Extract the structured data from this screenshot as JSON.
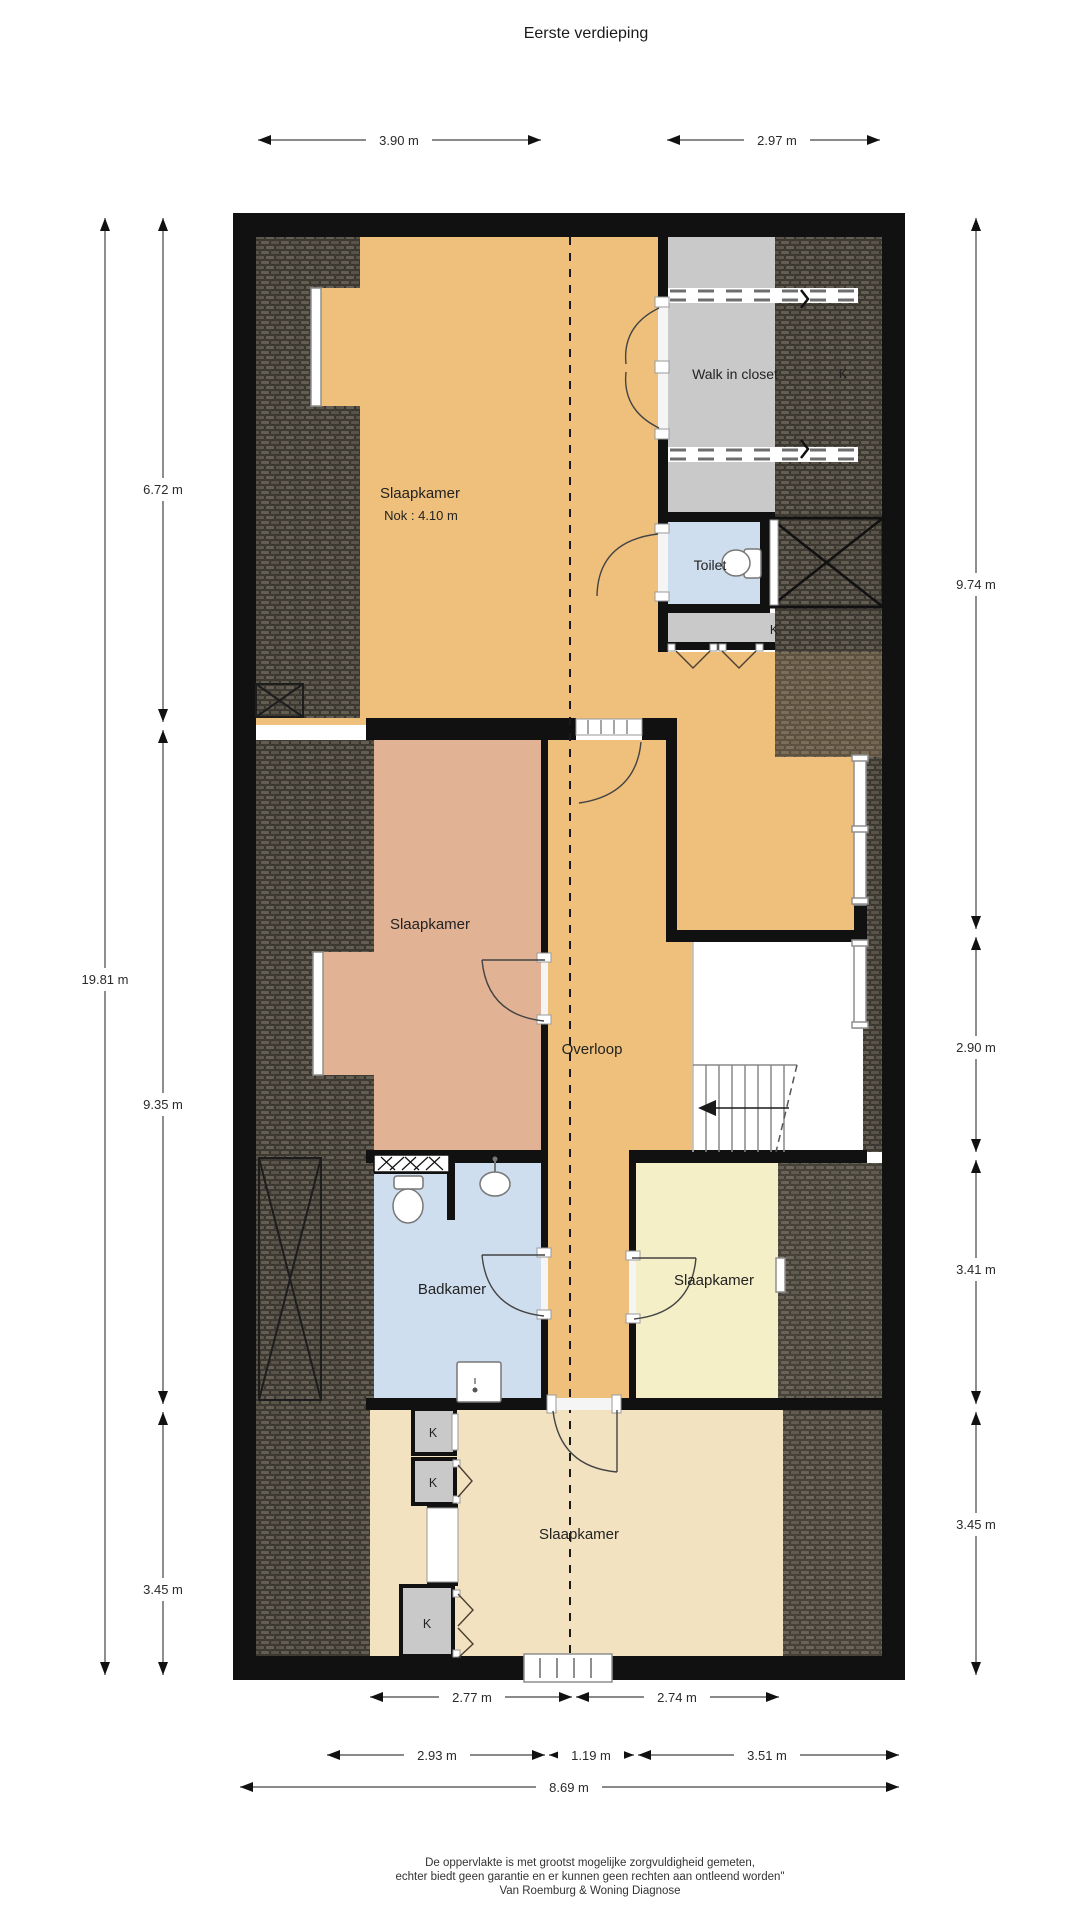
{
  "title": "Eerste verdieping",
  "floor_plan": {
    "rooms": {
      "bedroom_top": {
        "label": "Slaapkamer",
        "ridge_note": "Nok : 4.10 m"
      },
      "walk_in_closet": {
        "label": "Walk in closet"
      },
      "toilet": {
        "label": "Toilet"
      },
      "bedroom_left": {
        "label": "Slaapkamer"
      },
      "landing": {
        "label": "Overloop"
      },
      "bathroom": {
        "label": "Badkamer"
      },
      "bedroom_right": {
        "label": "Slaapkamer"
      },
      "bedroom_bottom": {
        "label": "Slaapkamer"
      },
      "closet_label": "K"
    },
    "dimensions": {
      "top": [
        "3.90 m",
        "2.97 m"
      ],
      "left_total": "19.81 m",
      "left_segments": [
        "6.72 m",
        "9.35 m",
        "3.45 m"
      ],
      "right_segments": [
        "9.74 m",
        "2.90 m",
        "3.41 m",
        "3.45 m"
      ],
      "bottom_room": [
        "2.77 m",
        "2.74 m"
      ],
      "bottom_sections": [
        "2.93 m",
        "1.19 m",
        "3.51 m"
      ],
      "bottom_total": "8.69 m"
    },
    "colors": {
      "floor_orange": "#efc07c",
      "floor_salmon": "#e1b294",
      "floor_yellow": "#f4efc7",
      "floor_beige": "#f3e2c0",
      "floor_blue": "#cfdeee",
      "closet_gray": "#c9c9c9",
      "roof_dark": "#4a453d",
      "wall": "#111111"
    }
  },
  "footer": {
    "line1": "De oppervlakte is met grootst mogelijke zorgvuldigheid gemeten,",
    "line2": "echter biedt geen garantie en er kunnen geen rechten aan ontleend worden\"",
    "line3": "Van Roemburg & Woning Diagnose"
  }
}
